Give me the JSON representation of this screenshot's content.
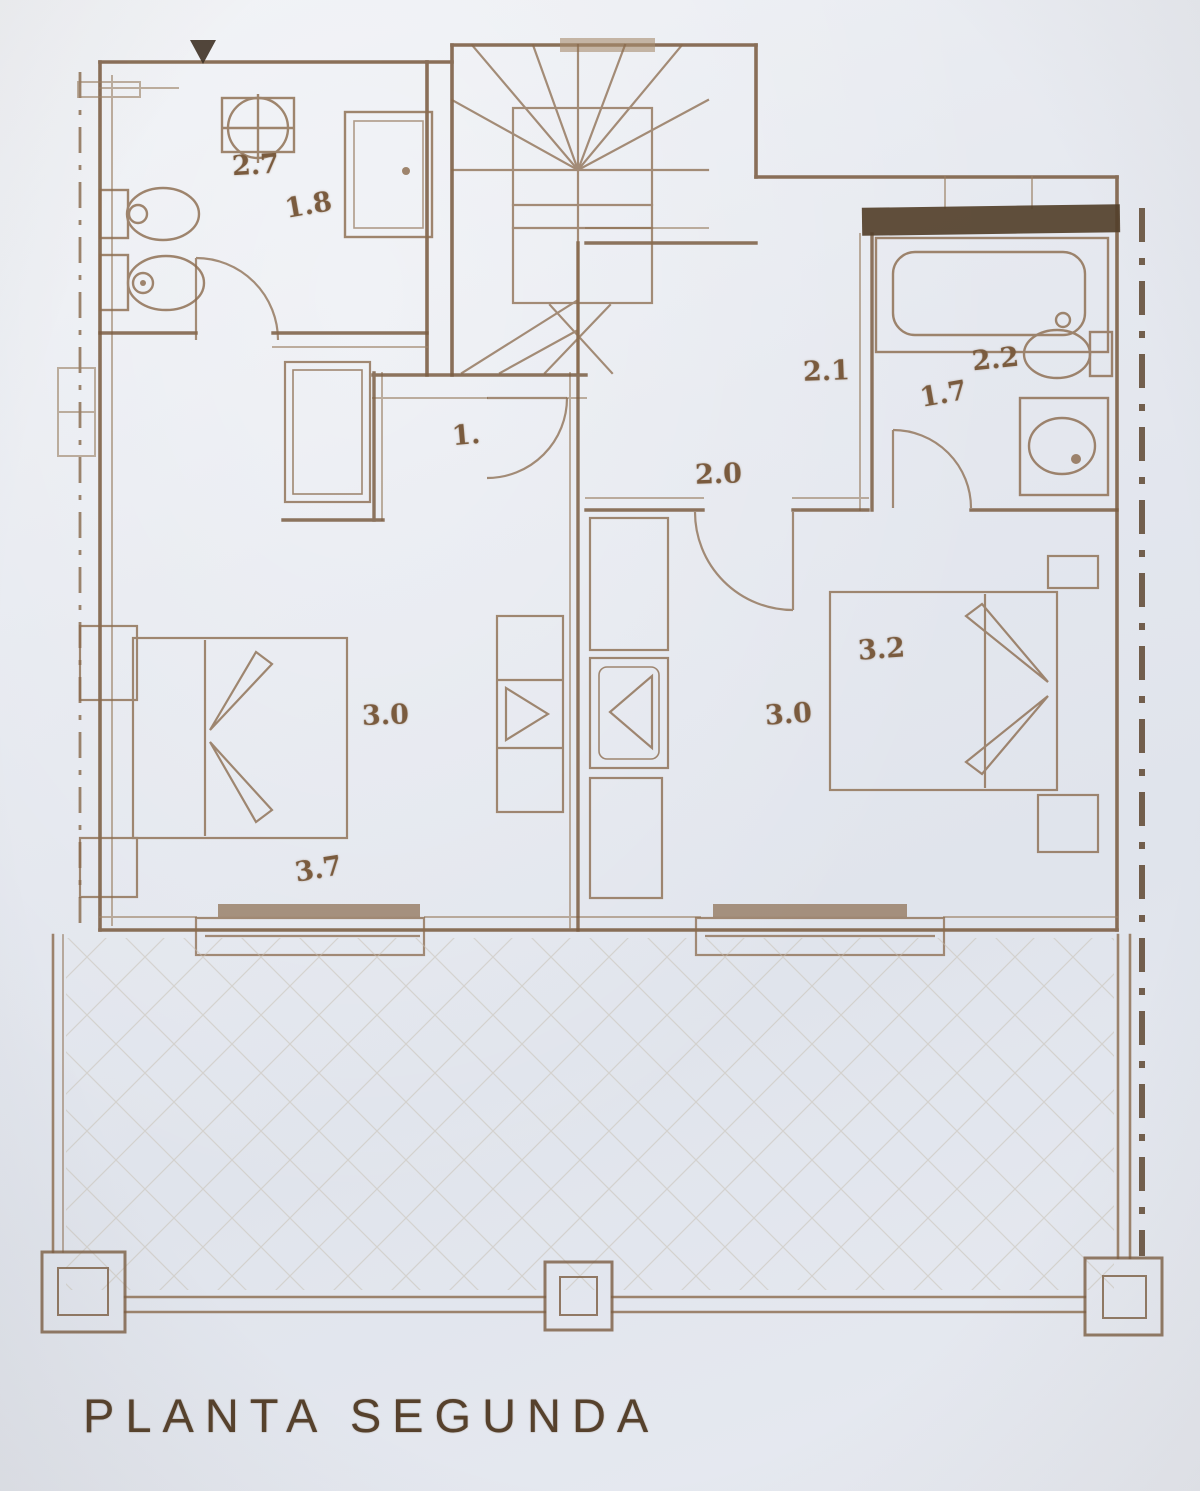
{
  "plan": {
    "floor_label": "PLANTA SEGUNDA",
    "dimension_labels": [
      {
        "id": "bath1-sink-width",
        "value": "2.7"
      },
      {
        "id": "bath1-width",
        "value": "1.8"
      },
      {
        "id": "hall-width",
        "value": "2.1"
      },
      {
        "id": "bath2-width",
        "value": "2.2"
      },
      {
        "id": "bath2-depth",
        "value": "1.7"
      },
      {
        "id": "hall-depth",
        "value": "2.0"
      },
      {
        "id": "corridor-width",
        "value": "1."
      },
      {
        "id": "bedroom1-depth",
        "value": "3.0"
      },
      {
        "id": "bedroom1-width",
        "value": "3.7"
      },
      {
        "id": "bedroom2-width",
        "value": "3.2"
      },
      {
        "id": "bedroom2-depth",
        "value": "3.0"
      }
    ],
    "colors": {
      "paper": "#e4e7ee",
      "ink": "#7b5d42",
      "ink_light": "#9a7f63",
      "ink_dark": "#54402b",
      "title_ink": "#56412c"
    }
  }
}
